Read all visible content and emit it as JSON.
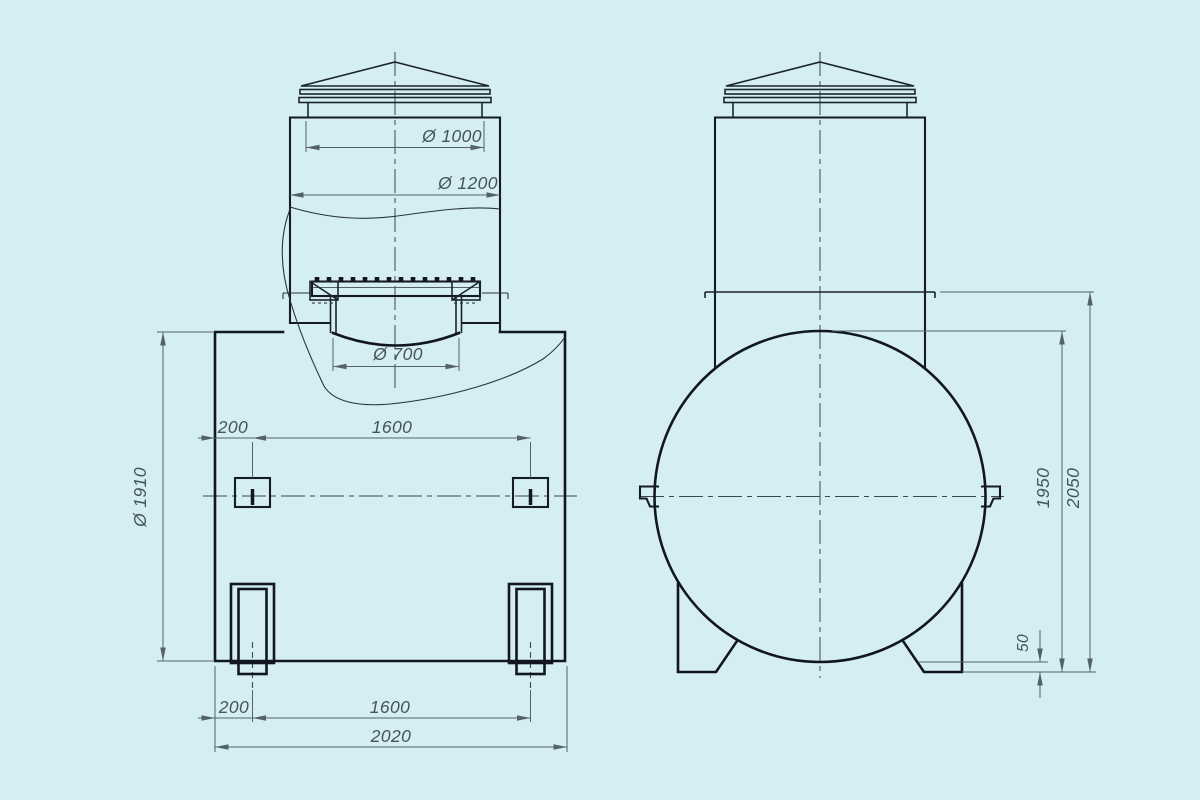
{
  "drawing": {
    "background_color": "#d5eef2",
    "outline_color": "#12161f",
    "dimension_color": "#54616d",
    "label_color": "#46525e",
    "dims": {
      "neck_inner": "Ø 1000",
      "neck_outer": "Ø 1200",
      "manhole": "Ø 700",
      "tank_diameter": "Ø 1910",
      "lug_offset": "200",
      "lug_spacing": "1600",
      "support_offset": "200",
      "support_spacing": "1600",
      "overall_length": "2020",
      "height_shell": "1950",
      "height_overall": "2050",
      "ground_clearance": "50"
    }
  }
}
